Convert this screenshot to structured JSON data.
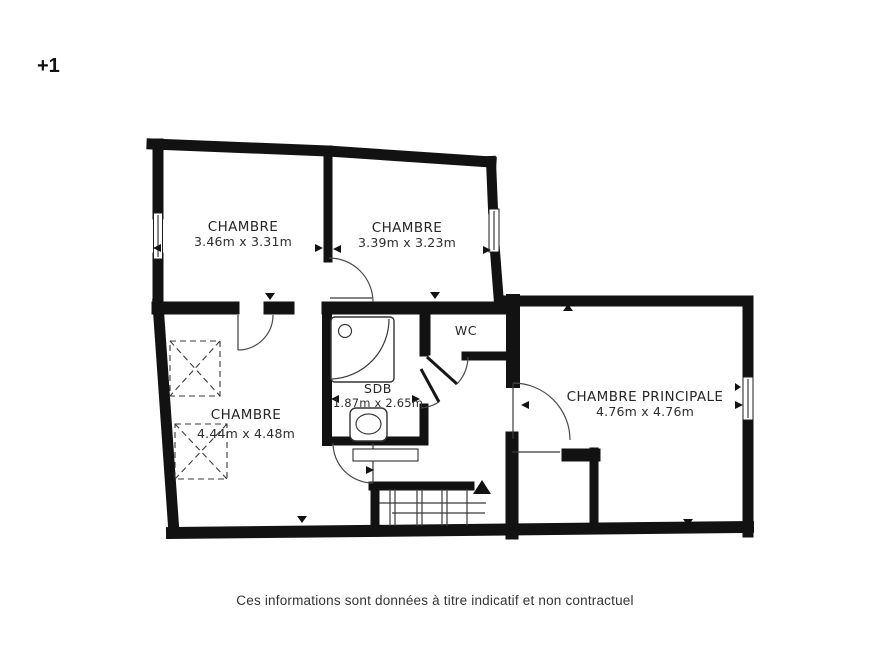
{
  "floor_indicator": "+1",
  "rooms": [
    {
      "id": "chambre-1",
      "name": "CHAMBRE",
      "dimensions": "3.46m x 3.31m"
    },
    {
      "id": "chambre-2",
      "name": "CHAMBRE",
      "dimensions": "3.39m x 3.23m"
    },
    {
      "id": "chambre-3",
      "name": "CHAMBRE",
      "dimensions": "4.44m x 4.48m"
    },
    {
      "id": "sdb",
      "name": "SDB",
      "dimensions": "1.87m x 2.65m"
    },
    {
      "id": "wc",
      "name": "WC"
    },
    {
      "id": "chambre-principale",
      "name": "CHAMBRE PRINCIPALE",
      "dimensions": "4.76m x 4.76m"
    }
  ],
  "footer": {
    "disclaimer": "Ces informations sont données à titre indicatif et non contractuel"
  },
  "icons": {
    "stairs_direction": "up-arrow"
  },
  "colors": {
    "background": "#ffffff",
    "wall": "#121212",
    "line": "#3a3a3a",
    "text": "#262626"
  }
}
